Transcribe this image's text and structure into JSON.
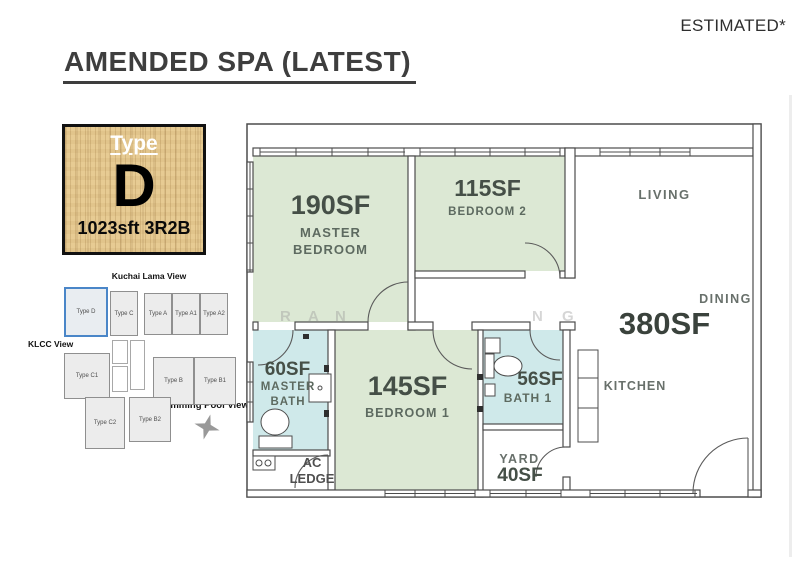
{
  "page": {
    "corner_note": "ESTIMATED*",
    "title": "AMENDED SPA (LATEST)"
  },
  "legend": {
    "type_label": "Type",
    "type_letter": "D",
    "spec": "1023sft 3R2B"
  },
  "site_plan": {
    "top_view": "Kuchai Lama View",
    "left_view": "KLCC View",
    "bottom_view": "Swimming Pool View",
    "highlighted_unit": "Type D",
    "units": {
      "d": "Type D",
      "c": "Type C",
      "a": "Type A",
      "a1": "Type A1",
      "a2": "Type A2",
      "c1": "Type C1",
      "b": "Type B",
      "b1": "Type B1",
      "c2": "Type C2",
      "b2": "Type B2"
    }
  },
  "floor_plan": {
    "rooms": {
      "master_bedroom": {
        "area": "190SF",
        "name": "MASTER BEDROOM"
      },
      "bedroom_2": {
        "area": "115SF",
        "name": "BEDROOM 2"
      },
      "living": {
        "name": "LIVING"
      },
      "dining": {
        "area": "380SF",
        "name": "DINING"
      },
      "master_bath": {
        "area": "60SF",
        "name": "MASTER BATH"
      },
      "bedroom_1": {
        "area": "145SF",
        "name": "BEDROOM 1"
      },
      "bath_1": {
        "area": "56SF",
        "name": "BATH 1"
      },
      "kitchen": {
        "name": "KITCHEN"
      },
      "yard": {
        "area": "40SF",
        "name": "YARD"
      },
      "ac_ledge": {
        "name": "AC LEDGE"
      }
    },
    "watermark": [
      "R",
      "A",
      "N",
      "N",
      "G"
    ]
  },
  "colors": {
    "room_green": "#dce8d4",
    "room_blue": "#cfe9ea",
    "highlight_blue": "#4a86c8",
    "wood": "#e7cb93",
    "title_text": "#3e3e3e"
  }
}
